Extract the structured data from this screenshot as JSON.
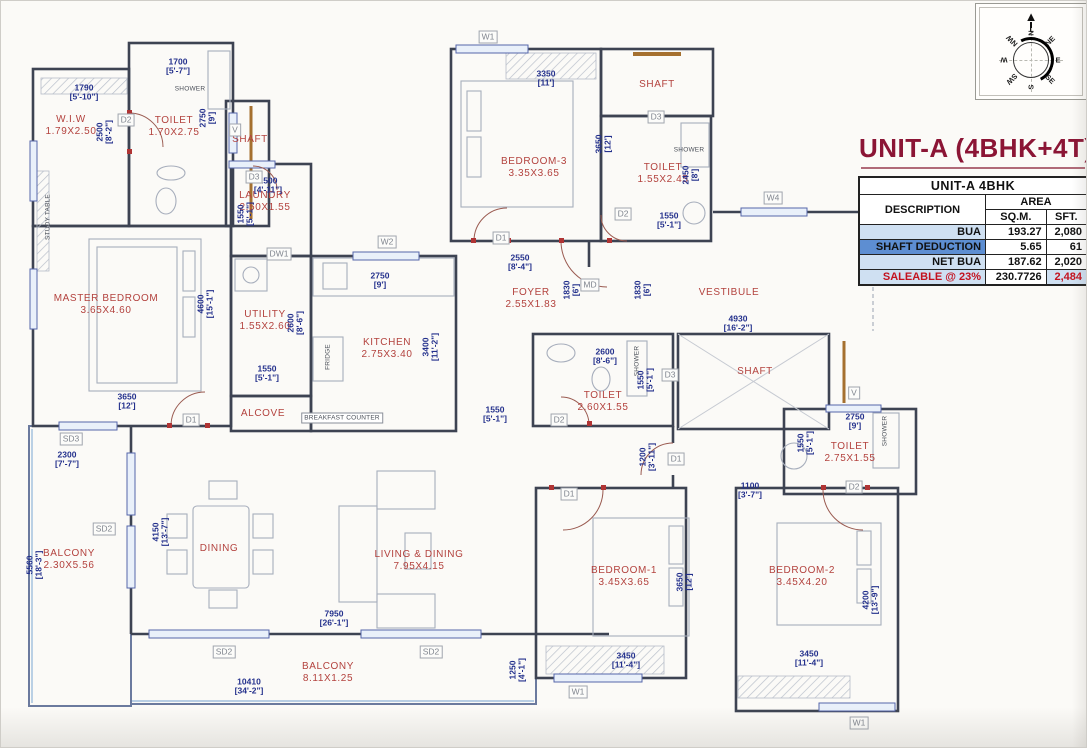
{
  "title": "UNIT-A (4BHK+4T)",
  "area_table": {
    "header": "UNIT-A 4BHK",
    "col_description": "DESCRIPTION",
    "col_area": "AREA",
    "col_sqm": "SQ.M.",
    "col_sft": "SFT.",
    "rows": [
      {
        "label": "BUA",
        "sqm": "193.27",
        "sft": "2,080",
        "style": "normal"
      },
      {
        "label": "SHAFT DEDUCTION",
        "sqm": "5.65",
        "sft": "61",
        "style": "highlight"
      },
      {
        "label": "NET BUA",
        "sqm": "187.62",
        "sft": "2,020",
        "style": "normal"
      },
      {
        "label": "SALEABLE @ 23%",
        "sqm": "230.7726",
        "sft": "2,484",
        "style": "saleable"
      }
    ]
  },
  "compass": {
    "directions": [
      "N",
      "NE",
      "E",
      "SE",
      "S",
      "SW",
      "W",
      "NW"
    ]
  },
  "colors": {
    "title_maroon": "#8b1535",
    "table_light_blue": "#cfe0f2",
    "table_mid_blue": "#5d8ed2",
    "table_red": "#c3121f",
    "room_label_red": "#b3423e",
    "dimension_navy": "#23308c",
    "wall_dark": "#3d4352"
  },
  "plan": {
    "rooms": [
      {
        "name": "W.I.W",
        "dims": "1.79X2.50",
        "x": 70,
        "y": 125
      },
      {
        "name": "TOILET",
        "dims": "1.70X2.75",
        "x": 173,
        "y": 126
      },
      {
        "name": "SHAFT",
        "x": 249,
        "y": 139
      },
      {
        "name": "LAUNDRY",
        "dims": "2.50X1.55",
        "x": 264,
        "y": 201
      },
      {
        "name": "MASTER BEDROOM",
        "dims": "3.65X4.60",
        "x": 105,
        "y": 304
      },
      {
        "name": "UTILITY",
        "dims": "1.55X2.60",
        "x": 264,
        "y": 320
      },
      {
        "name": "KITCHEN",
        "dims": "2.75X3.40",
        "x": 386,
        "y": 348
      },
      {
        "name": "ALCOVE",
        "x": 262,
        "y": 413
      },
      {
        "name": "BEDROOM-3",
        "dims": "3.35X3.65",
        "x": 533,
        "y": 167
      },
      {
        "name": "SHAFT",
        "x": 656,
        "y": 84
      },
      {
        "name": "TOILET",
        "dims": "1.55X2.45",
        "x": 662,
        "y": 173
      },
      {
        "name": "FOYER",
        "dims": "2.55X1.83",
        "x": 530,
        "y": 298
      },
      {
        "name": "VESTIBULE",
        "x": 728,
        "y": 292
      },
      {
        "name": "TOILET",
        "dims": "2.60X1.55",
        "x": 602,
        "y": 401
      },
      {
        "name": "SHAFT",
        "x": 754,
        "y": 371
      },
      {
        "name": "TOILET",
        "dims": "2.75X1.55",
        "x": 849,
        "y": 452
      },
      {
        "name": "BEDROOM-1",
        "dims": "3.45X3.65",
        "x": 623,
        "y": 576
      },
      {
        "name": "BEDROOM-2",
        "dims": "3.45X4.20",
        "x": 801,
        "y": 576
      },
      {
        "name": "DINING",
        "x": 218,
        "y": 548
      },
      {
        "name": "LIVING & DINING",
        "dims": "7.95X4.15",
        "x": 418,
        "y": 560
      },
      {
        "name": "BALCONY",
        "dims": "2.30X5.56",
        "x": 68,
        "y": 559
      },
      {
        "name": "BALCONY",
        "dims": "8.11X1.25",
        "x": 327,
        "y": 672
      }
    ],
    "dimensions": [
      {
        "mm": "1700",
        "ft": "[5'-7\"]",
        "x": 177,
        "y": 66
      },
      {
        "mm": "1790",
        "ft": "[5'-10\"]",
        "x": 83,
        "y": 92
      },
      {
        "mm": "2750",
        "ft": "[9']",
        "x": 207,
        "y": 117,
        "v": true
      },
      {
        "mm": "2500",
        "ft": "[8'-2\"]",
        "x": 104,
        "y": 131,
        "v": true
      },
      {
        "mm": "1500",
        "ft": "[4'-11\"]",
        "x": 267,
        "y": 185
      },
      {
        "mm": "1550",
        "ft": "[5'-1\"]",
        "x": 245,
        "y": 213,
        "v": true
      },
      {
        "mm": "3350",
        "ft": "[11']",
        "x": 545,
        "y": 78
      },
      {
        "mm": "3650",
        "ft": "[12']",
        "x": 603,
        "y": 143,
        "v": true
      },
      {
        "mm": "2450",
        "ft": "[8']",
        "x": 690,
        "y": 174,
        "v": true
      },
      {
        "mm": "1550",
        "ft": "[5'-1\"]",
        "x": 668,
        "y": 220
      },
      {
        "mm": "4600",
        "ft": "[15'-1\"]",
        "x": 205,
        "y": 303,
        "v": true
      },
      {
        "mm": "3650",
        "ft": "[12']",
        "x": 126,
        "y": 401
      },
      {
        "mm": "1550",
        "ft": "[5'-1\"]",
        "x": 266,
        "y": 373
      },
      {
        "mm": "2600",
        "ft": "[8'-6\"]",
        "x": 295,
        "y": 322,
        "v": true
      },
      {
        "mm": "2750",
        "ft": "[9']",
        "x": 379,
        "y": 280
      },
      {
        "mm": "3400",
        "ft": "[11'-2\"]",
        "x": 430,
        "y": 346,
        "v": true
      },
      {
        "mm": "2550",
        "ft": "[8'-4\"]",
        "x": 519,
        "y": 262
      },
      {
        "mm": "1830",
        "ft": "[6']",
        "x": 571,
        "y": 289,
        "v": true
      },
      {
        "mm": "1830",
        "ft": "[6']",
        "x": 642,
        "y": 289,
        "v": true
      },
      {
        "mm": "4930",
        "ft": "[16'-2\"]",
        "x": 737,
        "y": 323
      },
      {
        "mm": "2600",
        "ft": "[8'-6\"]",
        "x": 604,
        "y": 356
      },
      {
        "mm": "1550",
        "ft": "[5'-1\"]",
        "x": 645,
        "y": 379,
        "v": true
      },
      {
        "mm": "1550",
        "ft": "[5'-1\"]",
        "x": 494,
        "y": 414
      },
      {
        "mm": "2750",
        "ft": "[9']",
        "x": 854,
        "y": 421
      },
      {
        "mm": "1550",
        "ft": "[5'-1\"]",
        "x": 805,
        "y": 442,
        "v": true
      },
      {
        "mm": "1200",
        "ft": "[3'-11\"]",
        "x": 647,
        "y": 456,
        "v": true
      },
      {
        "mm": "1100",
        "ft": "[3'-7\"]",
        "x": 749,
        "y": 490
      },
      {
        "mm": "3650",
        "ft": "[12']",
        "x": 684,
        "y": 581,
        "v": true
      },
      {
        "mm": "3450",
        "ft": "[11'-4\"]",
        "x": 625,
        "y": 660
      },
      {
        "mm": "3450",
        "ft": "[11'-4\"]",
        "x": 808,
        "y": 658
      },
      {
        "mm": "4200",
        "ft": "[13'-9\"]",
        "x": 870,
        "y": 599,
        "v": true
      },
      {
        "mm": "4150",
        "ft": "[13'-7\"]",
        "x": 160,
        "y": 531,
        "v": true
      },
      {
        "mm": "7950",
        "ft": "[26'-1\"]",
        "x": 333,
        "y": 618
      },
      {
        "mm": "2300",
        "ft": "[7'-7\"]",
        "x": 66,
        "y": 459
      },
      {
        "mm": "5560",
        "ft": "[18'-3\"]",
        "x": 34,
        "y": 564,
        "v": true
      },
      {
        "mm": "10410",
        "ft": "[34'-2\"]",
        "x": 248,
        "y": 686
      },
      {
        "mm": "1250",
        "ft": "[4'-1\"]",
        "x": 517,
        "y": 669,
        "v": true
      }
    ],
    "tags": [
      {
        "label": "D2",
        "x": 125,
        "y": 119
      },
      {
        "label": "V",
        "x": 234,
        "y": 129
      },
      {
        "label": "D3",
        "x": 253,
        "y": 176
      },
      {
        "label": "DW1",
        "x": 278,
        "y": 253
      },
      {
        "label": "W2",
        "x": 386,
        "y": 241
      },
      {
        "label": "W1",
        "x": 487,
        "y": 36
      },
      {
        "label": "D3",
        "x": 655,
        "y": 116
      },
      {
        "label": "D2",
        "x": 622,
        "y": 213
      },
      {
        "label": "D1",
        "x": 500,
        "y": 237
      },
      {
        "label": "MD",
        "x": 589,
        "y": 284
      },
      {
        "label": "D3",
        "x": 669,
        "y": 374
      },
      {
        "label": "D2",
        "x": 558,
        "y": 419
      },
      {
        "label": "V",
        "x": 853,
        "y": 392
      },
      {
        "label": "D2",
        "x": 853,
        "y": 486
      },
      {
        "label": "D1",
        "x": 568,
        "y": 493
      },
      {
        "label": "D1",
        "x": 675,
        "y": 458
      },
      {
        "label": "D1",
        "x": 190,
        "y": 419
      },
      {
        "label": "SD3",
        "x": 70,
        "y": 438
      },
      {
        "label": "SD2",
        "x": 103,
        "y": 528
      },
      {
        "label": "SD2",
        "x": 223,
        "y": 651
      },
      {
        "label": "SD2",
        "x": 430,
        "y": 651
      },
      {
        "label": "W1",
        "x": 577,
        "y": 691
      },
      {
        "label": "W1",
        "x": 858,
        "y": 722
      },
      {
        "label": "W4",
        "x": 772,
        "y": 197
      }
    ],
    "fixtures": [
      {
        "text": "SHOWER",
        "x": 189,
        "y": 88
      },
      {
        "text": "SHOWER",
        "x": 688,
        "y": 149
      },
      {
        "text": "SHOWER",
        "x": 636,
        "y": 360,
        "v": true
      },
      {
        "text": "SHOWER",
        "x": 884,
        "y": 430,
        "v": true
      },
      {
        "text": "STUDY TABLE",
        "x": 47,
        "y": 216,
        "v": true
      },
      {
        "text": "FRIDGE",
        "x": 327,
        "y": 356,
        "v": true
      },
      {
        "text": "BREAKFAST COUNTER",
        "x": 341,
        "y": 417,
        "boxed": true
      }
    ]
  }
}
